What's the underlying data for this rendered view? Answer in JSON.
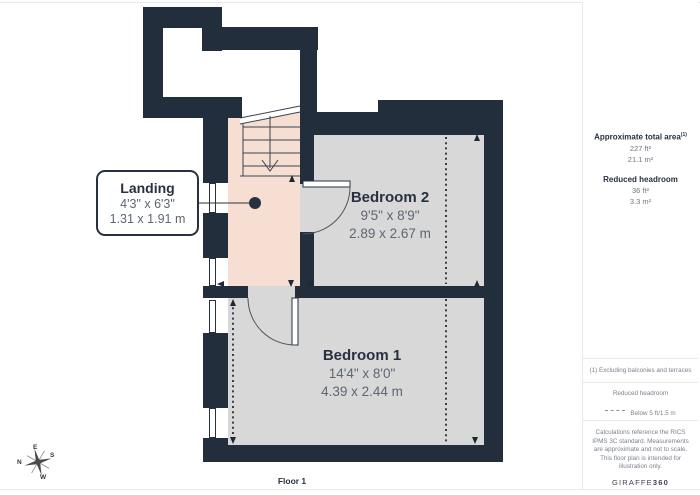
{
  "page": {
    "floor_label": "Floor 1"
  },
  "plan": {
    "rooms": [
      {
        "id": "landing",
        "name": "Landing",
        "imperial": "4'3\" x 6'3\"",
        "metric": "1.31 x 1.91 m"
      },
      {
        "id": "bedroom2",
        "name": "Bedroom 2",
        "imperial": "9'5\" x 8'9\"",
        "metric": "2.89 x 2.67 m"
      },
      {
        "id": "bedroom1",
        "name": "Bedroom 1",
        "imperial": "14'4\" x 8'0\"",
        "metric": "4.39 x 2.44 m"
      }
    ],
    "compass": {
      "n": "N",
      "e": "E",
      "s": "S",
      "w": "W"
    }
  },
  "sidebar": {
    "total_area_label": "Approximate total area",
    "total_area_sup": "(1)",
    "total_area_ft": "227 ft²",
    "total_area_m": "21.1 m²",
    "reduced_label": "Reduced headroom",
    "reduced_ft": "36 ft²",
    "reduced_m": "3.3 m²",
    "footnote": "(1) Excluding balconies and terraces",
    "legend_title": "Reduced headroom",
    "legend_value": "Below 5 ft/1.5 m",
    "disclaimer": "Calculations reference the RICS IPMS 3C standard. Measurements are approximate and not to scale. This floor plan is intended for illustration only.",
    "logo_text": "GIRAFFE",
    "logo_suffix": "360"
  },
  "colors": {
    "wall": "#232e3c",
    "line": "#273140",
    "floor-gray": "#d8d8d8",
    "floor-peach": "#f6dfd2",
    "text-dark": "#273140",
    "text-gray": "#5d6672",
    "sb-gray": "#6e7680",
    "border-light": "#e9e9e9"
  }
}
